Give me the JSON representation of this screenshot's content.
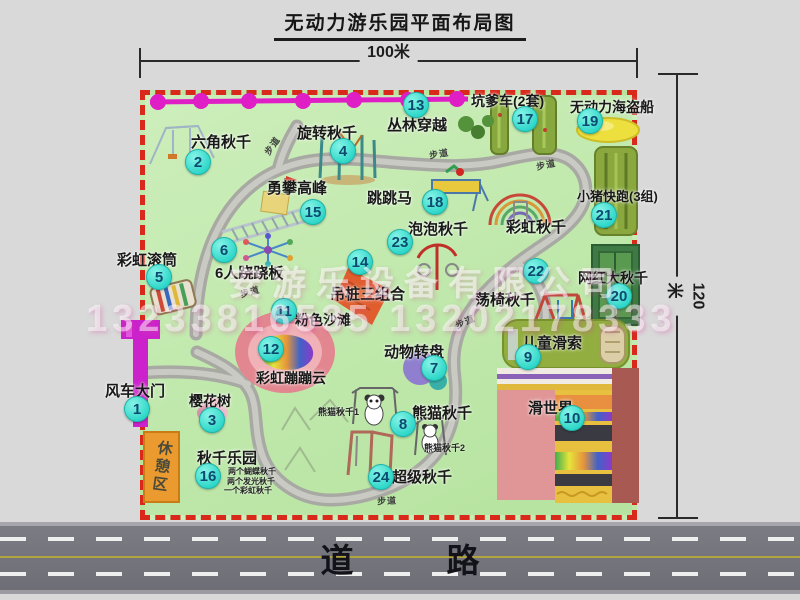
{
  "title": "无动力游乐园平面布局图",
  "dim_width": "100米",
  "dim_height": "120米",
  "road_label": "道　路",
  "rest_area": "休憩区",
  "watermark": {
    "company": "安游乐设备有限公司",
    "phones": "13233816535 13202178333"
  },
  "colors": {
    "border": "#d8291b",
    "park_green": "#bfe8ab",
    "marker": "#2ed7c9",
    "zipline": "#e01ec6",
    "road": "#74747c"
  },
  "markers": [
    {
      "num": "1",
      "label": "风车大门",
      "cx": 137,
      "cy": 409,
      "lx": 105,
      "ly": 380,
      "fs": 15
    },
    {
      "num": "2",
      "label": "六角秋千",
      "cx": 198,
      "cy": 162,
      "lx": 191,
      "ly": 131,
      "fs": 15
    },
    {
      "num": "3",
      "label": "樱花树",
      "cx": 212,
      "cy": 420,
      "lx": 189,
      "ly": 391,
      "fs": 14
    },
    {
      "num": "4",
      "label": "旋转秋千",
      "cx": 343,
      "cy": 151,
      "lx": 297,
      "ly": 122,
      "fs": 15
    },
    {
      "num": "5",
      "label": "彩虹滚筒",
      "cx": 159,
      "cy": 277,
      "lx": 117,
      "ly": 249,
      "fs": 15
    },
    {
      "num": "6",
      "label": "6人跷跷板",
      "cx": 224,
      "cy": 250,
      "lx": 215,
      "ly": 262,
      "fs": 15
    },
    {
      "num": "7",
      "label": "动物转盘",
      "cx": 434,
      "cy": 368,
      "lx": 384,
      "ly": 341,
      "fs": 15
    },
    {
      "num": "8",
      "label": "熊猫秋千",
      "cx": 403,
      "cy": 424,
      "lx": 412,
      "ly": 402,
      "fs": 15
    },
    {
      "num": "9",
      "label": "儿童滑索",
      "cx": 528,
      "cy": 357,
      "lx": 522,
      "ly": 332,
      "fs": 15
    },
    {
      "num": "10",
      "label": "滑世界",
      "cx": 572,
      "cy": 418,
      "lx": 528,
      "ly": 397,
      "fs": 15
    },
    {
      "num": "11",
      "label": "粉色沙滩",
      "cx": 284,
      "cy": 311,
      "lx": 295,
      "ly": 310,
      "fs": 14
    },
    {
      "num": "12",
      "label": "彩虹蹦蹦云",
      "cx": 271,
      "cy": 349,
      "lx": 256,
      "ly": 368,
      "fs": 14
    },
    {
      "num": "13",
      "label": "丛林穿越",
      "cx": 416,
      "cy": 105,
      "lx": 387,
      "ly": 114,
      "fs": 15
    },
    {
      "num": "14",
      "label": "吊桩三组合",
      "cx": 360,
      "cy": 262,
      "lx": 330,
      "ly": 283,
      "fs": 15
    },
    {
      "num": "15",
      "label": "勇攀高峰",
      "cx": 313,
      "cy": 212,
      "lx": 267,
      "ly": 177,
      "fs": 15
    },
    {
      "num": "16",
      "label": "秋千乐园",
      "cx": 208,
      "cy": 476,
      "lx": 197,
      "ly": 447,
      "fs": 15
    },
    {
      "num": "17",
      "label": "坑爹车(2套)",
      "cx": 525,
      "cy": 119,
      "lx": 471,
      "ly": 91,
      "fs": 14
    },
    {
      "num": "18",
      "label": "跳跳马",
      "cx": 435,
      "cy": 202,
      "lx": 367,
      "ly": 187,
      "fs": 15
    },
    {
      "num": "19",
      "label": "无动力海盗船",
      "cx": 590,
      "cy": 121,
      "lx": 570,
      "ly": 97,
      "fs": 14
    },
    {
      "num": "20",
      "label": "网红大秋千",
      "cx": 619,
      "cy": 296,
      "lx": 578,
      "ly": 268,
      "fs": 14
    },
    {
      "num": "21",
      "label": "小猪快跑(3组)",
      "cx": 604,
      "cy": 215,
      "lx": 577,
      "ly": 186,
      "fs": 13
    },
    {
      "num": "22",
      "label": "荡椅秋千",
      "cx": 536,
      "cy": 271,
      "lx": 475,
      "ly": 289,
      "fs": 15
    },
    {
      "num": "23",
      "label": "泡泡秋千",
      "cx": 400,
      "cy": 242,
      "lx": 408,
      "ly": 218,
      "fs": 15
    },
    {
      "num": "24",
      "label": "超级秋千",
      "cx": 381,
      "cy": 477,
      "lx": 392,
      "ly": 466,
      "fs": 15
    },
    {
      "num": null,
      "label": "彩虹秋千",
      "cx": null,
      "cy": null,
      "lx": 506,
      "ly": 216,
      "fs": 15
    }
  ],
  "sub_labels": [
    {
      "text": "两个蝴蝶秋千",
      "x": 228,
      "y": 466,
      "fs": 8
    },
    {
      "text": "两个发光秋千",
      "x": 227,
      "y": 476,
      "fs": 8
    },
    {
      "text": "一个彩虹秋千",
      "x": 224,
      "y": 485,
      "fs": 8
    },
    {
      "text": "熊猫秋千1",
      "x": 318,
      "y": 405,
      "fs": 9
    },
    {
      "text": "熊猫秋千2",
      "x": 424,
      "y": 441,
      "fs": 9
    }
  ],
  "path_labels": [
    {
      "text": "步道",
      "x": 262,
      "y": 139,
      "rot": -55
    },
    {
      "text": "步道",
      "x": 429,
      "y": 147,
      "rot": -10
    },
    {
      "text": "步道",
      "x": 536,
      "y": 158,
      "rot": -12
    },
    {
      "text": "步道",
      "x": 455,
      "y": 315,
      "rot": -25
    },
    {
      "text": "步道",
      "x": 377,
      "y": 494,
      "rot": -3
    },
    {
      "text": "步道",
      "x": 240,
      "y": 285,
      "rot": -15
    }
  ]
}
